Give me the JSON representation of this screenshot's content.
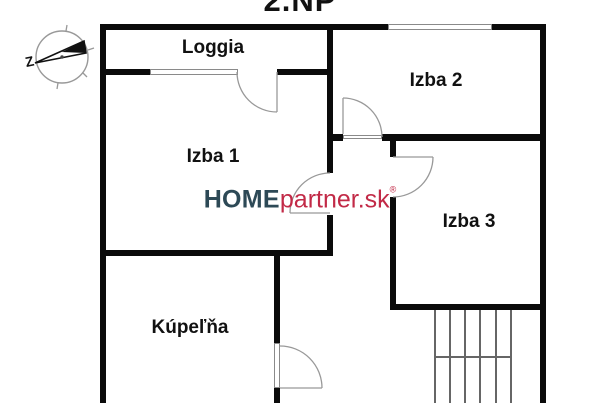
{
  "title": "2.NP",
  "compass": {
    "label_west": "Z"
  },
  "rooms": {
    "loggia": "Loggia",
    "izba1": "Izba 1",
    "izba2": "Izba 2",
    "izba3": "Izba 3",
    "kupelna": "Kúpeľňa"
  },
  "watermark": {
    "brand_bold": "HOME",
    "brand_rest": "partner.sk",
    "registered_mark": "®",
    "color_bold": "#2d4956",
    "color_rest": "#c22a47"
  },
  "icons": {
    "compass": "compass-west-arrow-icon"
  },
  "colors": {
    "wall": "#0b0b0b",
    "door_symbol": "#999999",
    "stairs": "#666666",
    "background": "#ffffff"
  }
}
